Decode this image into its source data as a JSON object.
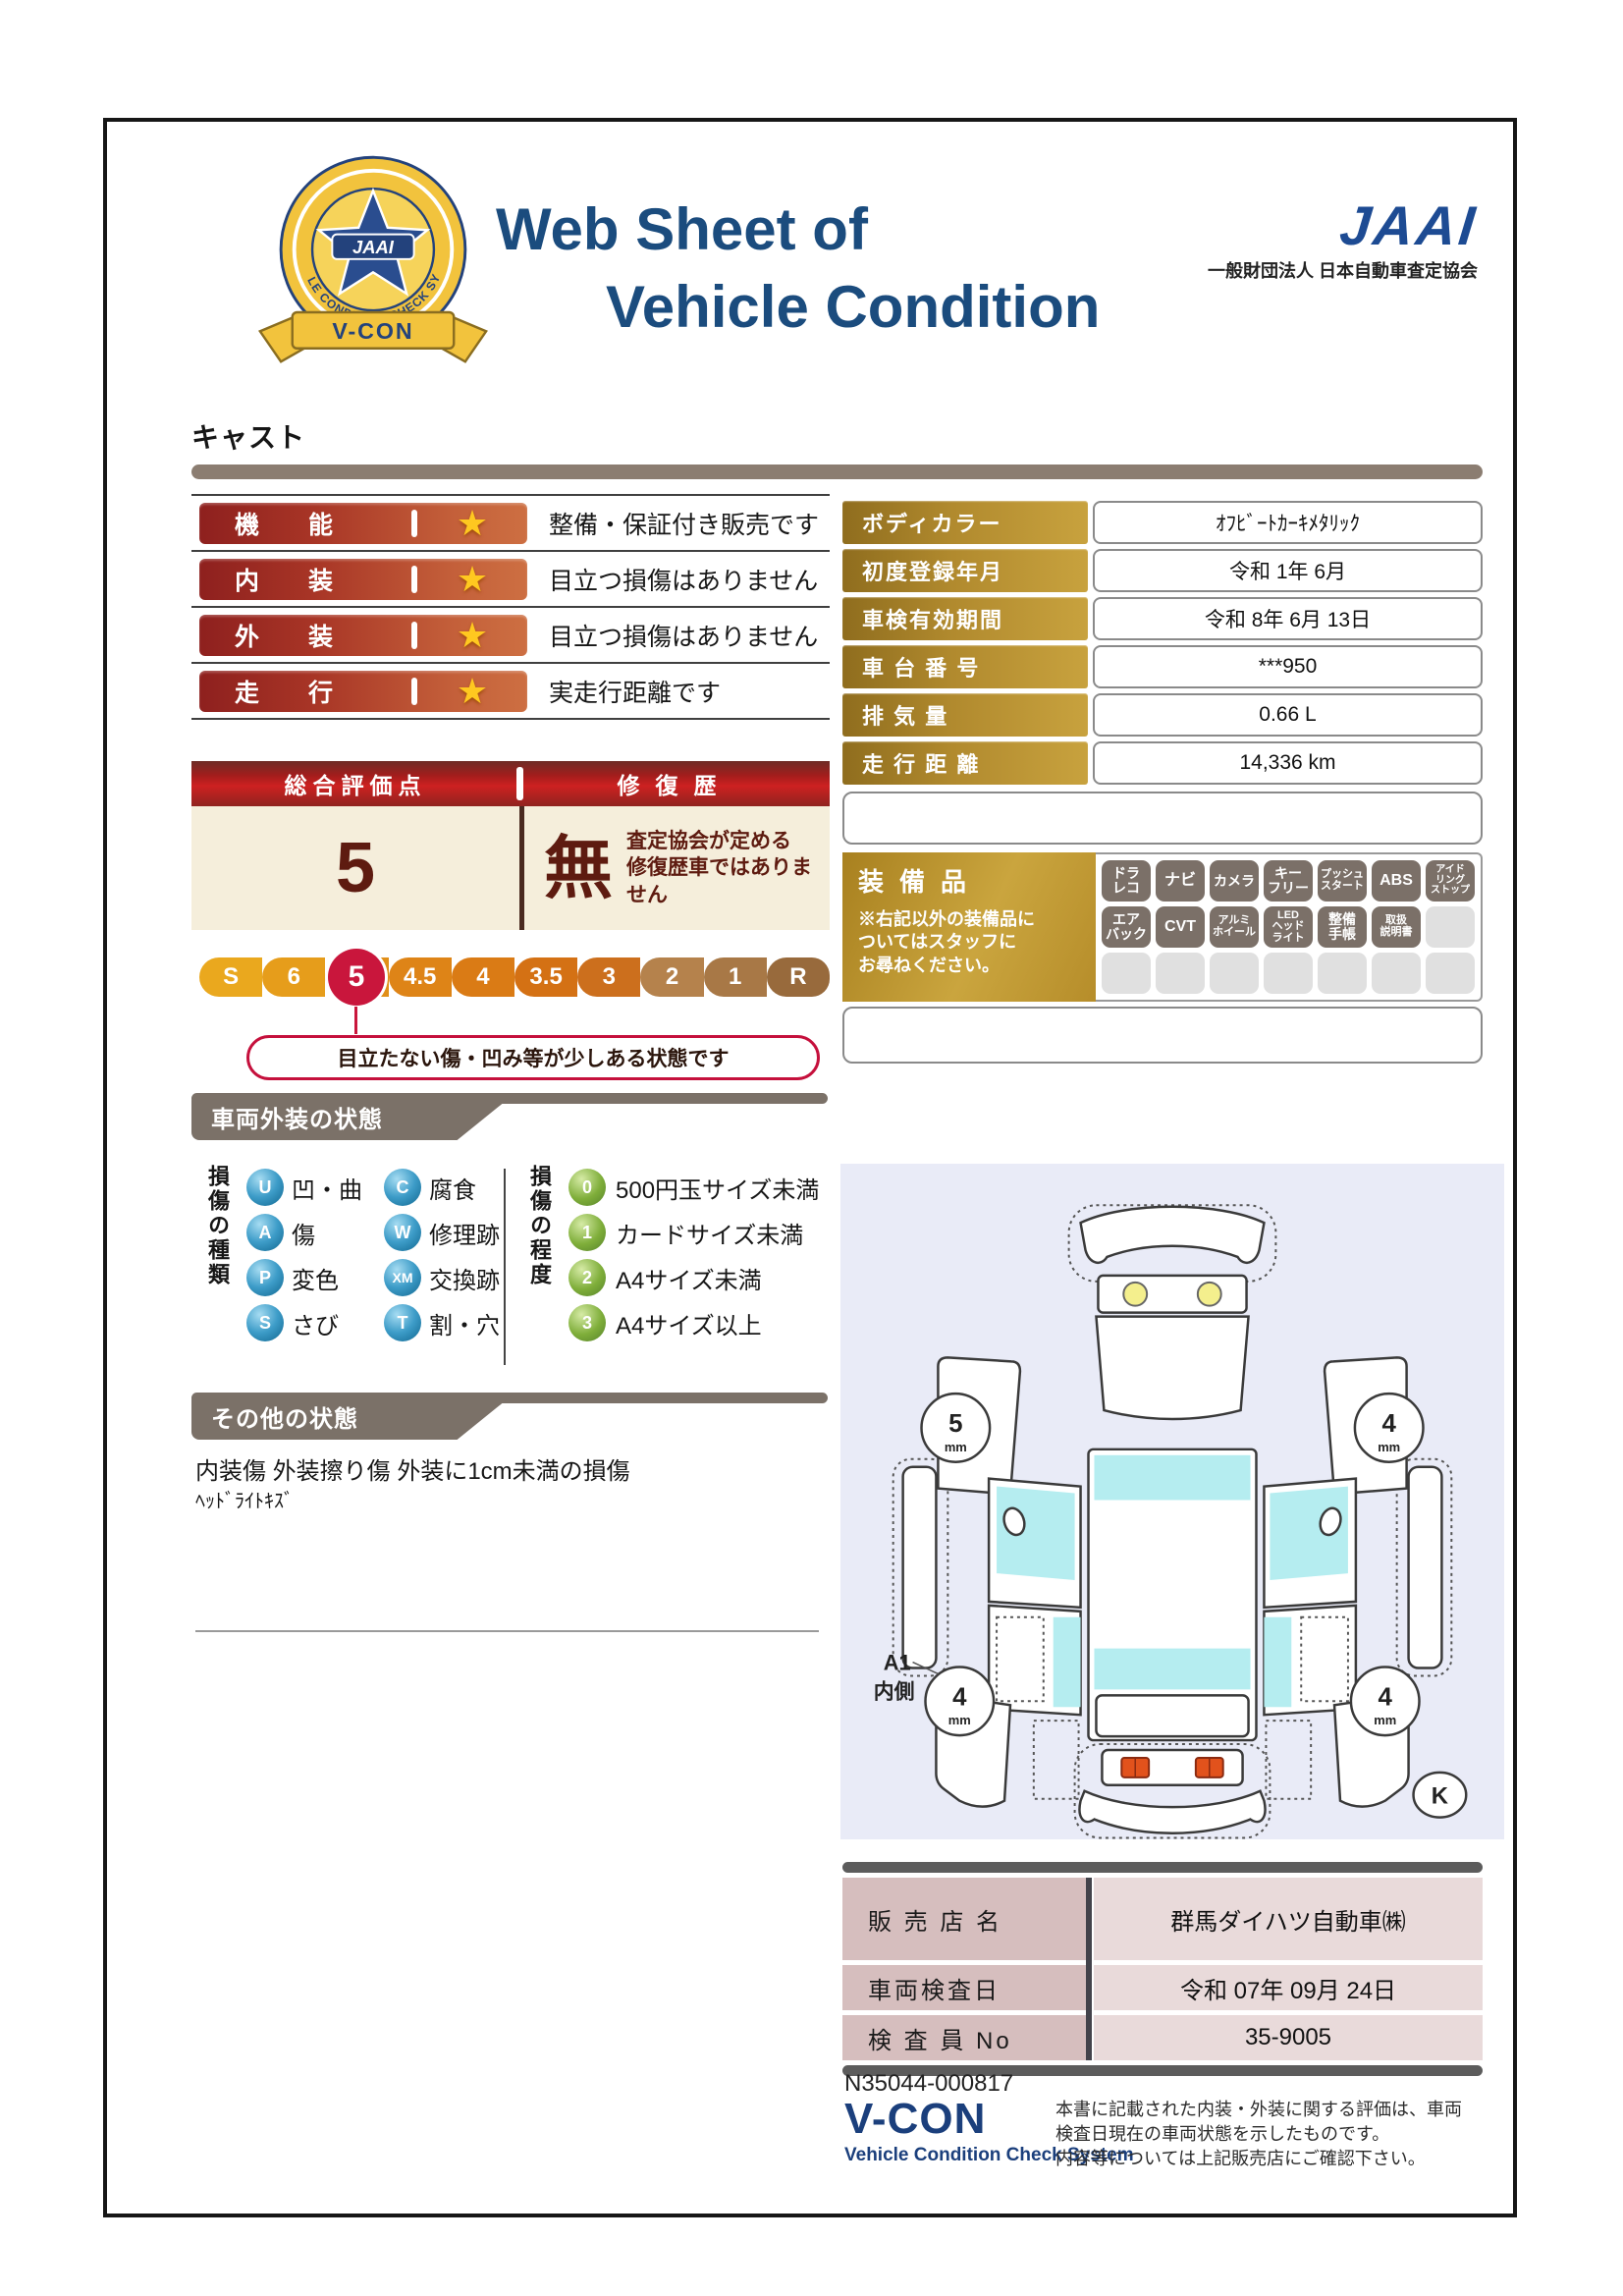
{
  "header": {
    "title_line1": "Web Sheet of",
    "title_line2": "Vehicle Condition",
    "jaai_logo": "JAAI",
    "jaai_subtitle": "一般財団法人 日本自動車査定協会",
    "badge": {
      "center": "JAAI",
      "ring": "VEHICLE CONDITION CHECK SYSTEM",
      "ribbon": "V-CON"
    }
  },
  "vehicle_name": "キャスト",
  "ratings": [
    {
      "label": "機能",
      "star": "★",
      "description": "整備・保証付き販売です"
    },
    {
      "label": "内装",
      "star": "★",
      "description": "目立つ損傷はありません"
    },
    {
      "label": "外装",
      "star": "★",
      "description": "目立つ損傷はありません"
    },
    {
      "label": "走行",
      "star": "★",
      "description": "実走行距離です"
    }
  ],
  "overall": {
    "score_title": "総合評価点",
    "repair_title": "修復歴",
    "score": "5",
    "repair_value": "無",
    "repair_note": "査定協会が定める\n修復歴車ではありません",
    "scale": [
      "S",
      "6",
      "5",
      "4.5",
      "4",
      "3.5",
      "3",
      "2",
      "1",
      "R"
    ],
    "selected": "5",
    "bubble": "目立たない傷・凹み等が少しある状態です"
  },
  "vehicle_info": [
    {
      "label": "ボディカラー",
      "value": "ｵﾌﾋﾞｰﾄｶｰｷﾒﾀﾘｯｸ"
    },
    {
      "label": "初度登録年月",
      "value": "令和 1年 6月"
    },
    {
      "label": "車検有効期間",
      "value": "令和 8年 6月 13日"
    },
    {
      "label": "車 台 番 号",
      "value": "***950"
    },
    {
      "label": "排  気  量",
      "value": "0.66 L"
    },
    {
      "label": "走 行 距 離",
      "value": "14,336 km"
    }
  ],
  "equipment": {
    "title": "装備品",
    "note": "※右記以外の装備品に\nついてはスタッフに\nお尋ねください。",
    "items": [
      "ドラ\nレコ",
      "ナビ",
      "カメラ",
      "キー\nフリー",
      "プッシュ\nスタート",
      "ABS",
      "アイド\nリング\nストップ",
      "エア\nバック",
      "CVT",
      "アルミ\nホイール",
      "LED\nヘッド\nライト",
      "整備\n手帳",
      "取扱\n説明書"
    ]
  },
  "damage_section": {
    "title": "車両外装の状態",
    "kind_title": "損傷の種類",
    "kinds": [
      {
        "code": "U",
        "label": "凹・曲"
      },
      {
        "code": "A",
        "label": "傷"
      },
      {
        "code": "P",
        "label": "変色"
      },
      {
        "code": "S",
        "label": "さび"
      },
      {
        "code": "C",
        "label": "腐食"
      },
      {
        "code": "W",
        "label": "修理跡"
      },
      {
        "code": "XM",
        "label": "交換跡"
      },
      {
        "code": "T",
        "label": "割・穴"
      }
    ],
    "degree_title": "損傷の程度",
    "degrees": [
      {
        "code": "0",
        "label": "500円玉サイズ未満"
      },
      {
        "code": "1",
        "label": "カードサイズ未満"
      },
      {
        "code": "2",
        "label": "A4サイズ未満"
      },
      {
        "code": "3",
        "label": "A4サイズ以上"
      }
    ]
  },
  "other_section": {
    "title": "その他の状態",
    "line1": "内装傷 外装擦り傷 外装に1cm未満の損傷",
    "line2": "ﾍｯﾄﾞﾗｲﾄｷｽﾞ"
  },
  "diagram": {
    "tires": {
      "front_left": "5",
      "front_right": "4",
      "rear_left": "4",
      "rear_right": "4"
    },
    "unit": "mm",
    "annotation_line1": "A1",
    "annotation_line2": "内側",
    "corner_mark": "K"
  },
  "dealer": [
    {
      "label": "販 売 店 名",
      "value": "群馬ダイハツ自動車㈱"
    },
    {
      "label": "車両検査日",
      "value": "令和 07年 09月 24日"
    },
    {
      "label": "検 査 員 No",
      "value": "35-9005"
    }
  ],
  "footer": {
    "document_no": "N35044-000817",
    "vcon": "V-CON",
    "vcon_sub": "Vehicle Condition Check System",
    "disclaimer": "本書に記載された内装・外装に関する評価は、車両\n検査日現在の車両状態を示したものです。\n内容等については上記販売店にご確認下さい。"
  },
  "colors": {
    "title_blue": "#1b4c7e",
    "rating_red": "#8e201e",
    "gold": "#b8923a",
    "maroon_text": "#5e1b10",
    "accent_crimson": "#c9163c",
    "section_gray": "#7b7168",
    "panel_lavender": "#e9ebf7",
    "window_cyan": "#b5edf0"
  }
}
